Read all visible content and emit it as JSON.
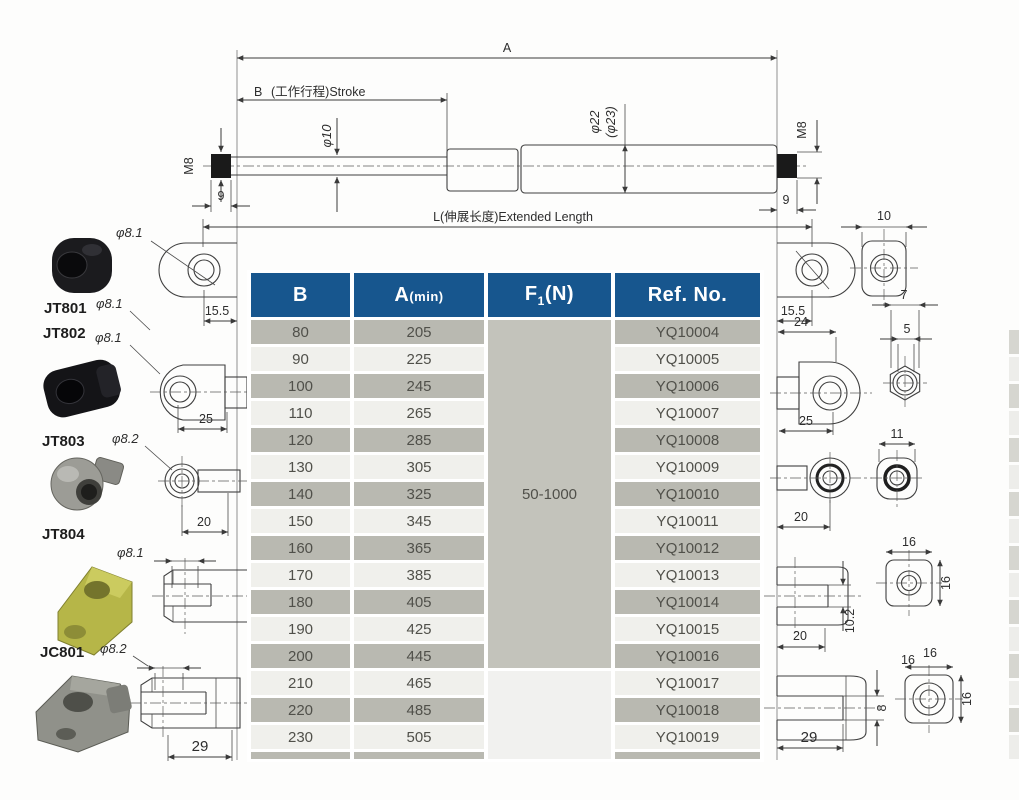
{
  "drawing": {
    "dim_a": "A",
    "dim_b": "B",
    "stroke_label": "(工作行程)Stroke",
    "rod_dia": "φ10",
    "tube_dia": "φ22",
    "tube_dia_alt": "(φ23)",
    "thread_left": "M8",
    "thread_left_len": "9",
    "thread_right": "M8",
    "thread_right_len": "9",
    "extended_label": "L(伸展长度)Extended Length"
  },
  "left_fittings": {
    "eyelet1_dia": "φ8.1",
    "eyelet1_width": "15.5",
    "jt801": "JT801",
    "jt801_dia": "φ8.1",
    "jt802": "JT802",
    "jt802_dia": "φ8.1",
    "eyelet2_width": "25",
    "jt803": "JT803",
    "jt803_dia": "φ8.2",
    "ball_width": "20",
    "jt804": "JT804",
    "jt804_dia": "φ8.1",
    "jc801": "JC801",
    "jc801_dia": "φ8.2",
    "clevis_width": "29"
  },
  "right_fittings": {
    "eyelet1_width": "15.5",
    "nut1_width": "10",
    "eyelet2_len": "24",
    "eyelet2_width": "25",
    "hex_flat": "7",
    "hex_hole": "5",
    "ball_width": "20",
    "ball_side_width": "11",
    "fork_width": "20",
    "fork_slot": "10.2",
    "fork_sq_w": "16",
    "fork_sq_h": "16",
    "clevis_width": "29",
    "clevis_slot": "8",
    "clevis_sq_w": "16",
    "clevis_sq_w2": "16",
    "clevis_sq_h": "16"
  },
  "table": {
    "headers": {
      "b": "B",
      "a_main": "A",
      "a_sub": "(min)",
      "f_main": "F",
      "f_sub": "1",
      "f_unit": "(N)",
      "ref": "Ref. No."
    },
    "f1_range": "50-1000",
    "rows": [
      {
        "b": "80",
        "a": "205",
        "ref": "YQ10004"
      },
      {
        "b": "90",
        "a": "225",
        "ref": "YQ10005"
      },
      {
        "b": "100",
        "a": "245",
        "ref": "YQ10006"
      },
      {
        "b": "110",
        "a": "265",
        "ref": "YQ10007"
      },
      {
        "b": "120",
        "a": "285",
        "ref": "YQ10008"
      },
      {
        "b": "130",
        "a": "305",
        "ref": "YQ10009"
      },
      {
        "b": "140",
        "a": "325",
        "ref": "YQ10010"
      },
      {
        "b": "150",
        "a": "345",
        "ref": "YQ10011"
      },
      {
        "b": "160",
        "a": "365",
        "ref": "YQ10012"
      },
      {
        "b": "170",
        "a": "385",
        "ref": "YQ10013"
      },
      {
        "b": "180",
        "a": "405",
        "ref": "YQ10014"
      },
      {
        "b": "190",
        "a": "425",
        "ref": "YQ10015"
      },
      {
        "b": "200",
        "a": "445",
        "ref": "YQ10016"
      },
      {
        "b": "210",
        "a": "465",
        "ref": "YQ10017"
      },
      {
        "b": "220",
        "a": "485",
        "ref": "YQ10018"
      },
      {
        "b": "230",
        "a": "505",
        "ref": "YQ10019"
      }
    ]
  },
  "colors": {
    "header_bg": "#17568e",
    "row_dark": "#b9b9b1",
    "row_light": "#f0f0ec",
    "f1_cell": "#c3c3bb",
    "f1_cell_light": "#f1f1ef"
  }
}
